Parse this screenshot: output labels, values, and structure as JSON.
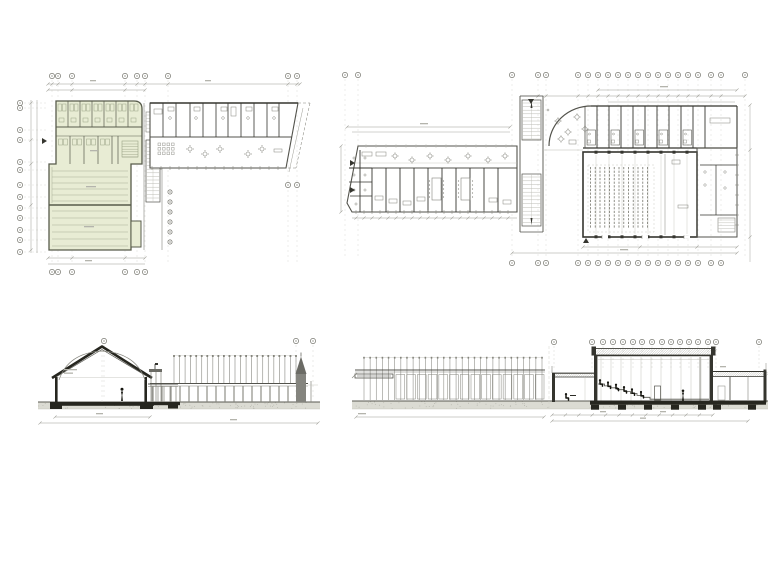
{
  "sheet": {
    "background": "#ffffff",
    "width": 768,
    "height": 576
  },
  "colors": {
    "ink_dark": "#35352f",
    "ink": "#53534c",
    "ink_light": "#84847c",
    "ink_faint": "#bcbcb4",
    "leader": "#cdcdc5",
    "dim": "#9c9c94",
    "text_dash": "#b4b4ac",
    "bubble_stroke": "#74746c",
    "bubble_mark": "#8e8e86",
    "highlight_fill": "#e8ecd4",
    "highlight_wall": "#575b4b",
    "highlight_line": "#9aa286",
    "court_line": "#a9af97",
    "ground_fill": "#dbdbd3",
    "ground_dot": "#b1b1a8",
    "ground_line": "#5a5a52",
    "slab": "#26261f",
    "figure": "#15150f",
    "spire_body": "#84847e",
    "spire_roof": "#6b6b65",
    "hatch": "#a4a49c",
    "glass": "#90908a",
    "white": "#ffffff"
  },
  "plan_left": {
    "name": "west-building-floor-plan",
    "grid_top_x": [
      52,
      58,
      72,
      125,
      137,
      145,
      168,
      288,
      297
    ],
    "grid_top_y": 76,
    "grid_bottom_x": [
      52,
      58,
      72,
      125,
      137,
      145
    ],
    "grid_bottom_y": 272,
    "grid_left_x": 20,
    "grid_left_y": [
      103,
      108,
      130,
      140,
      162,
      170,
      185,
      197,
      208,
      218,
      230,
      240,
      252
    ],
    "side_tag_x": 170,
    "side_tag_y": [
      192,
      202,
      212,
      222,
      232,
      242
    ],
    "right_bubbles": [
      [
        288,
        185
      ],
      [
        297,
        185
      ]
    ],
    "upper_hall_lines": 6,
    "lower_hall_lines": 6,
    "upper_room_divider_x": [
      68,
      80,
      92,
      104,
      116,
      128
    ],
    "band2_divider_x": [
      70,
      84,
      98,
      112
    ],
    "wing_divider_x": [
      163,
      176,
      190,
      203,
      216,
      228,
      241,
      254,
      267,
      279
    ],
    "wing_table_x": [
      190,
      205,
      220,
      248,
      262
    ]
  },
  "plan_right": {
    "name": "east-building-floor-plan",
    "grid_top_x": [
      345,
      358,
      512,
      538,
      546,
      578,
      588,
      598,
      608,
      618,
      628,
      638,
      648,
      658,
      668,
      678,
      688,
      698,
      711,
      721,
      745
    ],
    "grid_top_y": 75,
    "grid_bottom_x": [
      512,
      538,
      546,
      578,
      588,
      598,
      608,
      618,
      628,
      638,
      648,
      658,
      668,
      678,
      688,
      698,
      711,
      721
    ],
    "grid_bottom_y": 263,
    "wing_divider_x": [
      372,
      386,
      400,
      414,
      428,
      442,
      456,
      470,
      484,
      498
    ],
    "lounge_table_x": [
      395,
      412,
      430,
      448,
      468,
      488,
      505
    ],
    "strip_divider_x": [
      597,
      609,
      621,
      633,
      645,
      657,
      669,
      681,
      693,
      705
    ],
    "seat_cols": 13,
    "seat_rows": 17,
    "pilaster_x": [
      596,
      609,
      622,
      635,
      648,
      661,
      674,
      687
    ]
  },
  "section_left": {
    "name": "cross-section-through-gable-hall",
    "grid_x": [
      104,
      296,
      313
    ],
    "grid_y": 341,
    "canopy_posts": 23,
    "arcade_columns": 17
  },
  "section_right": {
    "name": "long-section-through-auditorium",
    "grid_x": [
      554,
      592,
      603,
      613,
      623,
      633,
      642,
      652,
      662,
      671,
      680,
      689,
      698,
      708,
      716,
      759
    ],
    "grid_y": 342,
    "colonnade_posts": 30,
    "glazing_panels": 14,
    "seated_x": [
      600,
      608,
      616,
      624,
      632,
      641
    ],
    "footing_x": [
      595,
      622,
      648,
      675,
      702
    ],
    "right_footing_x": [
      717,
      752
    ]
  }
}
